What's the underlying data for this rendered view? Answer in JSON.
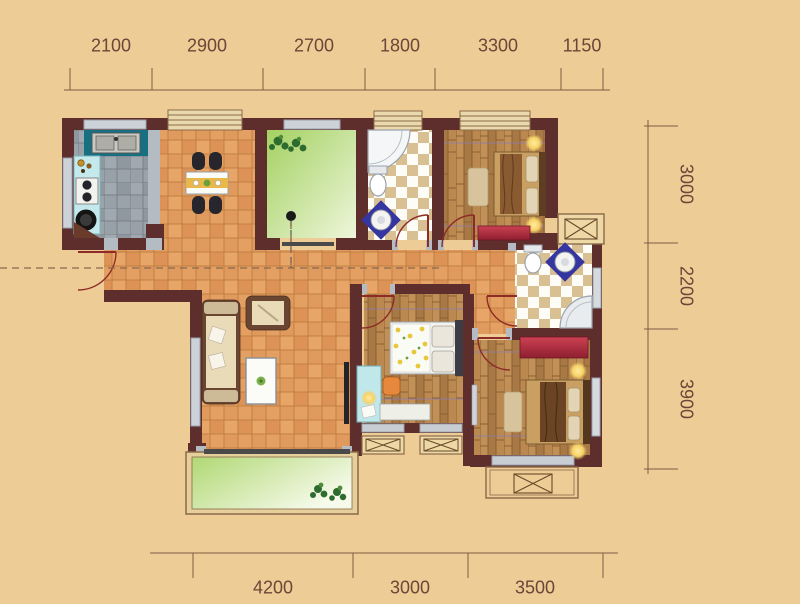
{
  "page": {
    "title": "residential-apartment-floor-plan"
  },
  "dims": {
    "top": [
      "2100",
      "2900",
      "2700",
      "1800",
      "3300",
      "1150"
    ],
    "right": [
      "3000",
      "2200",
      "3900"
    ],
    "bottom": [
      "4200",
      "3000",
      "3500"
    ]
  },
  "colors": {
    "background": "#eecc96",
    "wall": "#5e2e2c",
    "wall_jamb_grey": "#b5bbc3",
    "dimension_text": "#6e4538",
    "dimension_line": "#7d5c46",
    "door_arc": "#8e2b28",
    "tile_orange": "#e19a5e",
    "tile_grey": "#98a0a8",
    "checker_tan": "#d8c092",
    "wood": "#b5854d",
    "green_floor": "#a8d468",
    "counter_teal": "#176f82",
    "counter_cyan": "#c3e9ec",
    "dresser_red": "#b02c3e",
    "sink_mat_blue": "#3636a0",
    "lamp_glow": "#ffe9a8"
  },
  "rooms": [
    "kitchen",
    "dining-room",
    "study-green-room",
    "bathroom-1",
    "bedroom-1",
    "hallway",
    "living-room",
    "bedroom-2",
    "bathroom-2",
    "master-bedroom",
    "balcony",
    "duct-shaft",
    "ac-platforms"
  ]
}
